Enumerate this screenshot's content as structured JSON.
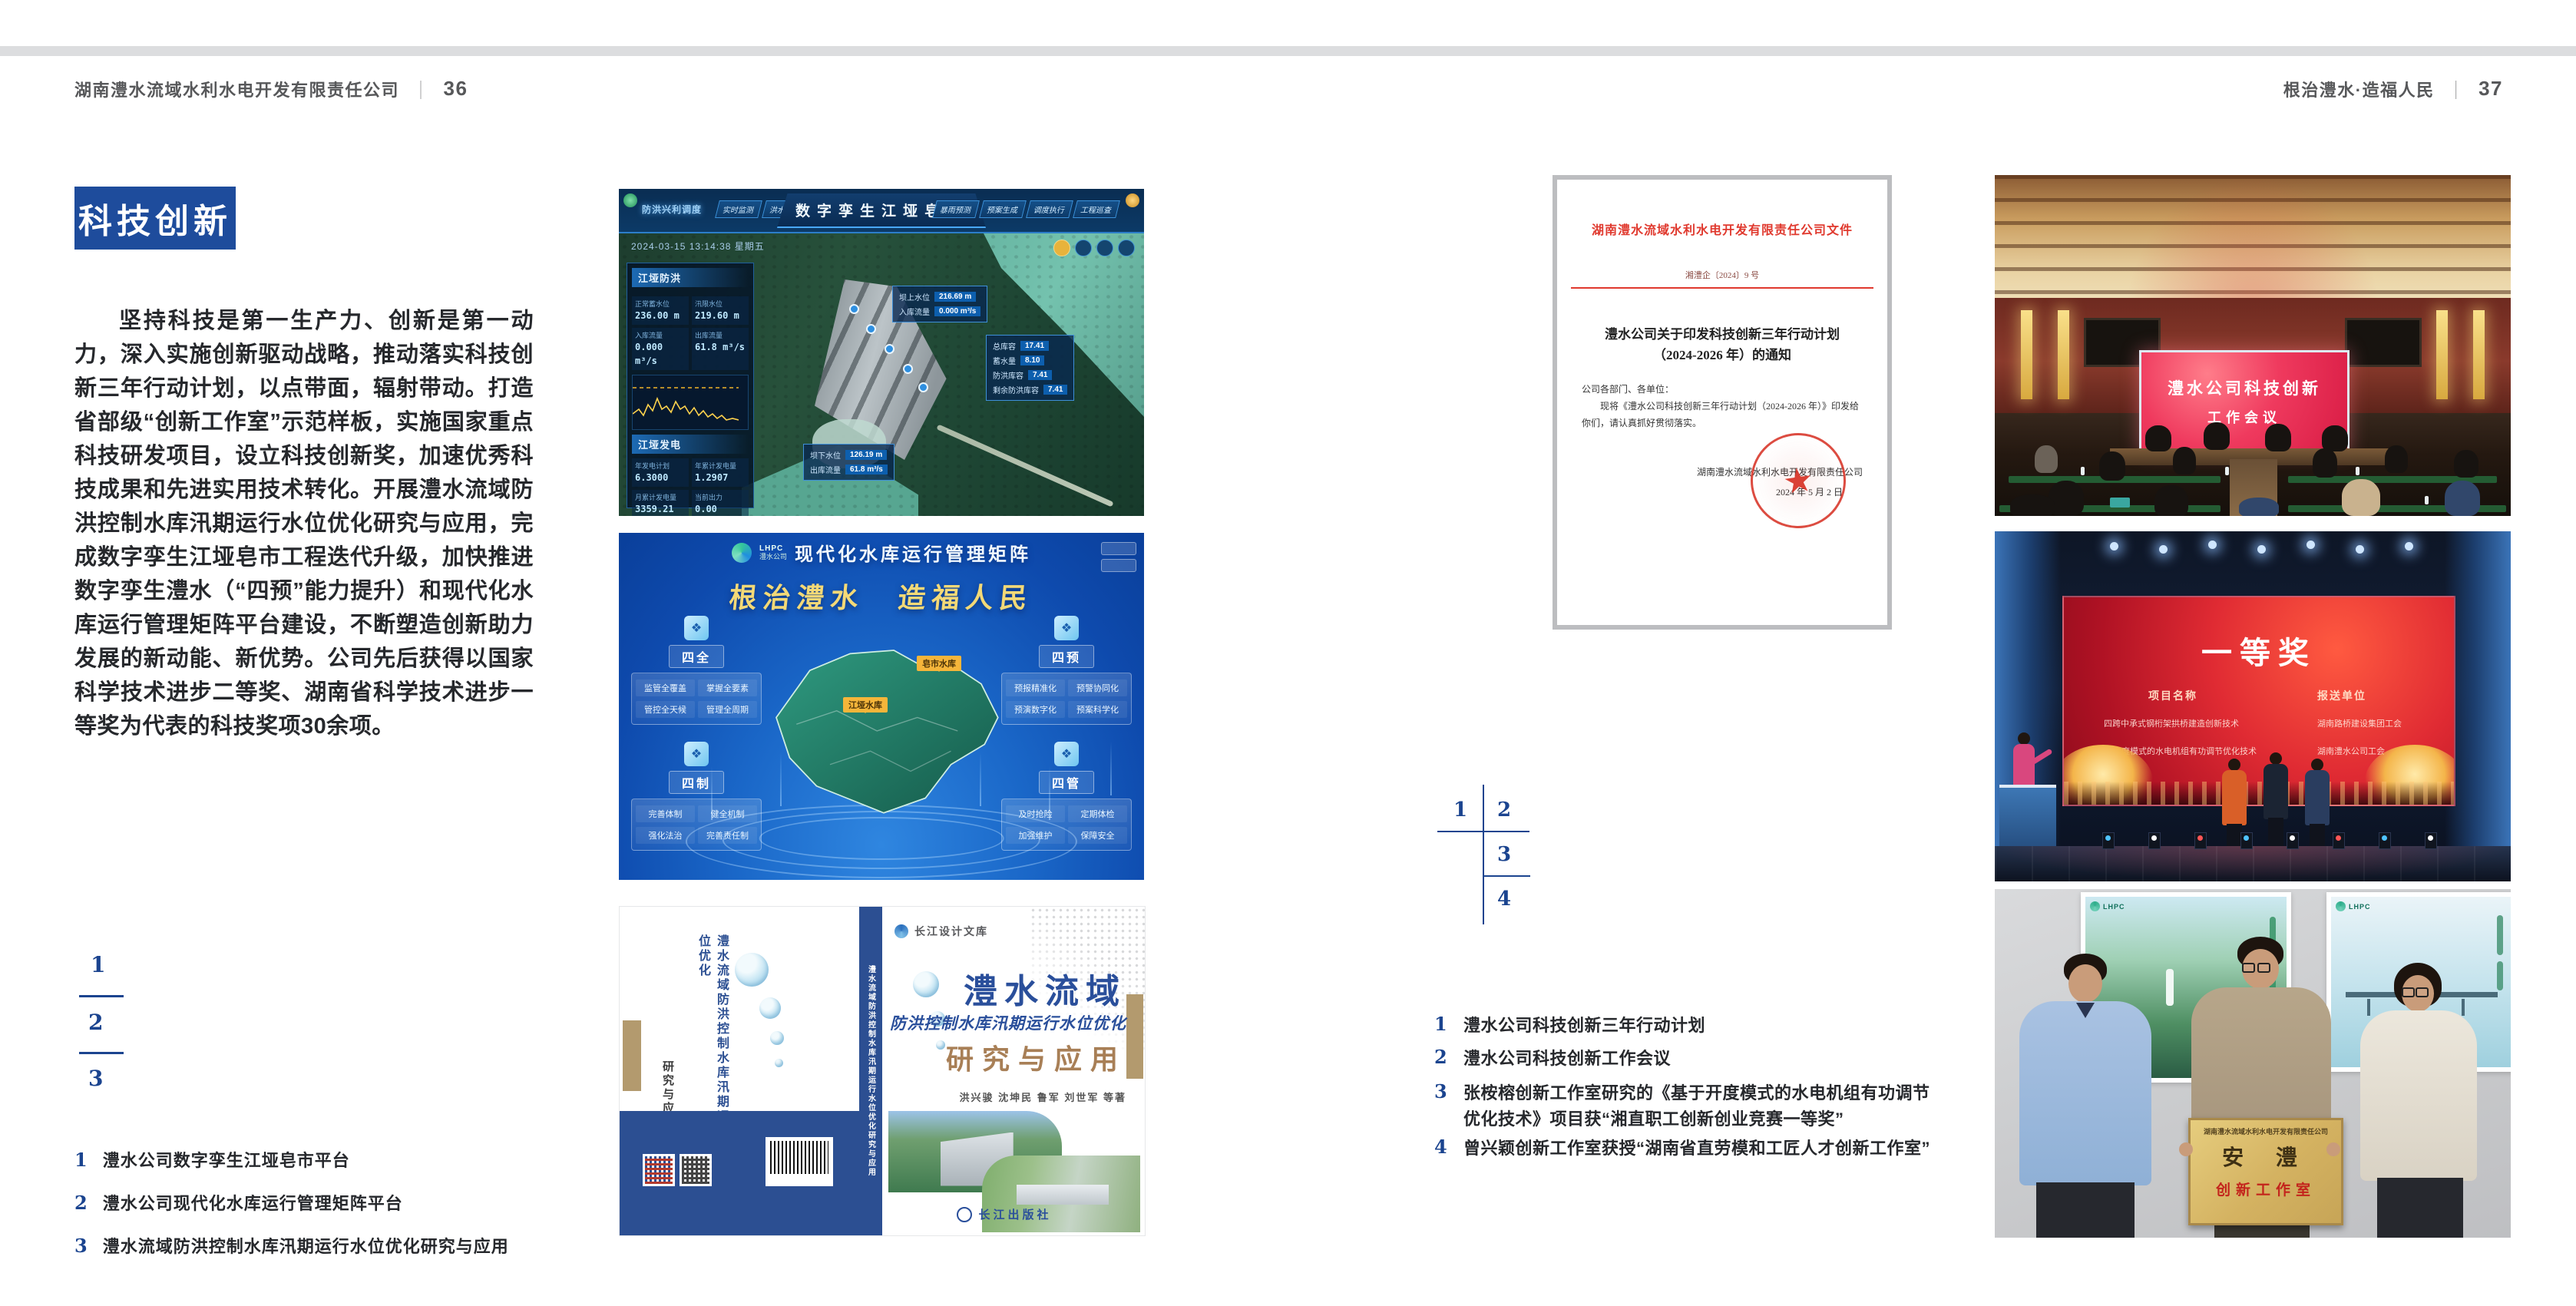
{
  "header": {
    "left": {
      "company": "湖南澧水流域水利水电开发有限责任公司",
      "divider": "｜",
      "page": "36"
    },
    "right": {
      "slogan": "根治澧水·造福人民",
      "divider": "｜",
      "page": "37"
    }
  },
  "icons": {
    "seal_star": "★",
    "panel_icon": "❖"
  },
  "left_page": {
    "section_title": "科技创新",
    "body": "坚持科技是第一生产力、创新是第一动力，深入实施创新驱动战略，推动落实科技创新三年行动计划，以点带面，辐射带动。打造省部级“创新工作室”示范样板，实施国家重点科技研发项目，设立科技创新奖，加速优秀科技成果和先进实用技术转化。开展澧水流域防洪控制水库汛期运行水位优化研究与应用，完成数字孪生江垭皂市工程迭代升级，加快推进数字孪生澧水（“四预”能力提升）和现代化水库运行管理矩阵平台建设，不断塑造创新助力发展的新动能、新优势。公司先后获得以国家科学技术进步二等奖、湖南省科学技术进步一等奖为代表的科技奖项30余项。",
    "index_numbers": {
      "n1": "1",
      "n2": "2",
      "n3": "3"
    },
    "captions": [
      {
        "no": "1",
        "text": "澧水公司数字孪生江垭皂市平台"
      },
      {
        "no": "2",
        "text": "澧水公司现代化水库运行管理矩阵平台"
      },
      {
        "no": "3",
        "text": "澧水流域防洪控制水库汛期运行水位优化研究与应用"
      }
    ]
  },
  "dashboard": {
    "badge": "防洪兴利调度",
    "title": "数字孪生江垭皂市",
    "tabs_left": [
      "实时监测",
      "洪水预报",
      "防洪预警"
    ],
    "tabs_right": [
      "暴雨预测",
      "预案生成",
      "调度执行",
      "工程巡查"
    ],
    "datetime": "2024-03-15 13:14:38 星期五",
    "panel1_title": "江垭防洪",
    "stats1": [
      {
        "label": "正常蓄水位",
        "value": "236.00 m"
      },
      {
        "label": "汛限水位",
        "value": "219.60 m"
      },
      {
        "label": "入库流量",
        "value": "0.000 m³/s"
      },
      {
        "label": "出库流量",
        "value": "61.8 m³/s"
      }
    ],
    "panel2_title": "江垭发电",
    "stats2": [
      {
        "label": "年发电计划",
        "value": "6.3000"
      },
      {
        "label": "年累计发电量",
        "value": "1.2907"
      },
      {
        "label": "月累计发电量",
        "value": "3359.21"
      },
      {
        "label": "当前出力",
        "value": "0.00"
      }
    ],
    "tooltip1": [
      {
        "label": "坝上水位",
        "value": "216.69 m"
      },
      {
        "label": "入库流量",
        "value": "0.000 m³/s"
      }
    ],
    "tooltip2": [
      {
        "label": "总库容",
        "value": "17.41"
      },
      {
        "label": "蓄水量",
        "value": "8.10"
      },
      {
        "label": "防洪库容",
        "value": "7.41"
      },
      {
        "label": "剩余防洪库容",
        "value": "7.41"
      }
    ],
    "tooltip3": [
      {
        "label": "坝下水位",
        "value": "126.19 m"
      },
      {
        "label": "出库流量",
        "value": "61.8 m³/s"
      }
    ]
  },
  "matrix": {
    "logo_top": "LHPC",
    "logo_bottom": "澧水公司",
    "title": "现代化水库运行管理矩阵",
    "slogan": "根治澧水　造福人民",
    "tags": [
      {
        "text": "皂市水库"
      },
      {
        "text": "江垭水库"
      }
    ],
    "panels": [
      {
        "title": "四全",
        "items": [
          "监管全覆盖",
          "掌握全要素",
          "管控全天候",
          "管理全周期"
        ]
      },
      {
        "title": "四预",
        "items": [
          "预报精准化",
          "预警协同化",
          "预演数字化",
          "预案科学化"
        ]
      },
      {
        "title": "四制",
        "items": [
          "完善体制",
          "健全机制",
          "强化法治",
          "完善责任制"
        ]
      },
      {
        "title": "四管",
        "items": [
          "及时抢险",
          "定期体检",
          "加强维护",
          "保障安全"
        ]
      }
    ]
  },
  "book": {
    "series": "长江设计文库",
    "title_main": "澧水流域",
    "title_sub": "防洪控制水库汛期运行水位优化",
    "title_tail": "研究与应用",
    "authors": "洪兴骏 沈坤民 鲁军 刘世军 等著",
    "publisher": "长江出版社",
    "spine_title": "澧水流域防洪控制水库汛期运行水位优化研究与应用",
    "back_title_1": "澧水流域防洪控制水库汛期运行水位优化",
    "back_title_2": "研究与应用"
  },
  "right_page": {
    "index_numbers": {
      "n1": "1",
      "n2": "2",
      "n3": "3",
      "n4": "4"
    },
    "captions": [
      {
        "no": "1",
        "text": "澧水公司科技创新三年行动计划"
      },
      {
        "no": "2",
        "text": "澧水公司科技创新工作会议"
      },
      {
        "no": "3",
        "text": "张桉榕创新工作室研究的《基于开度模式的水电机组有功调节优化技术》项目获“湘直职工创新创业竞赛一等奖”"
      },
      {
        "no": "4",
        "text": "曾兴颖创新工作室获授“湖南省直劳模和工匠人才创新工作室”"
      }
    ]
  },
  "document": {
    "header": "湖南澧水流域水利水电开发有限责任公司文件",
    "doc_no": "湘澧企〔2024〕9 号",
    "title_line1": "澧水公司关于印发科技创新三年行动计划",
    "title_line2": "（2024-2026 年）的通知",
    "salutation": "公司各部门、各单位：",
    "body": "现将《澧水公司科技创新三年行动计划（2024-2026 年）》印发给你们，请认真抓好贯彻落实。",
    "signer": "湖南澧水流域水利水电开发有限责任公司",
    "date": "2024 年 5 月 2 日"
  },
  "meeting": {
    "screen_line1": "澧水公司科技创新",
    "screen_line2": "工作会议"
  },
  "award": {
    "title": "一等奖",
    "col1": "项目名称",
    "col2": "报送单位",
    "rows": [
      {
        "project": "四跨中承式钢桁架拱桥建造创新技术",
        "unit": "湖南路桥建设集团工会"
      },
      {
        "project": "基于开度模式的水电机组有功调节优化技术",
        "unit": "湖南澧水公司工会"
      }
    ]
  },
  "plaque": {
    "poster_logo": "LHPC",
    "top_line": "湖南澧水流域水利水电开发有限责任公司",
    "main": "安 澧",
    "sub": "创新工作室"
  }
}
